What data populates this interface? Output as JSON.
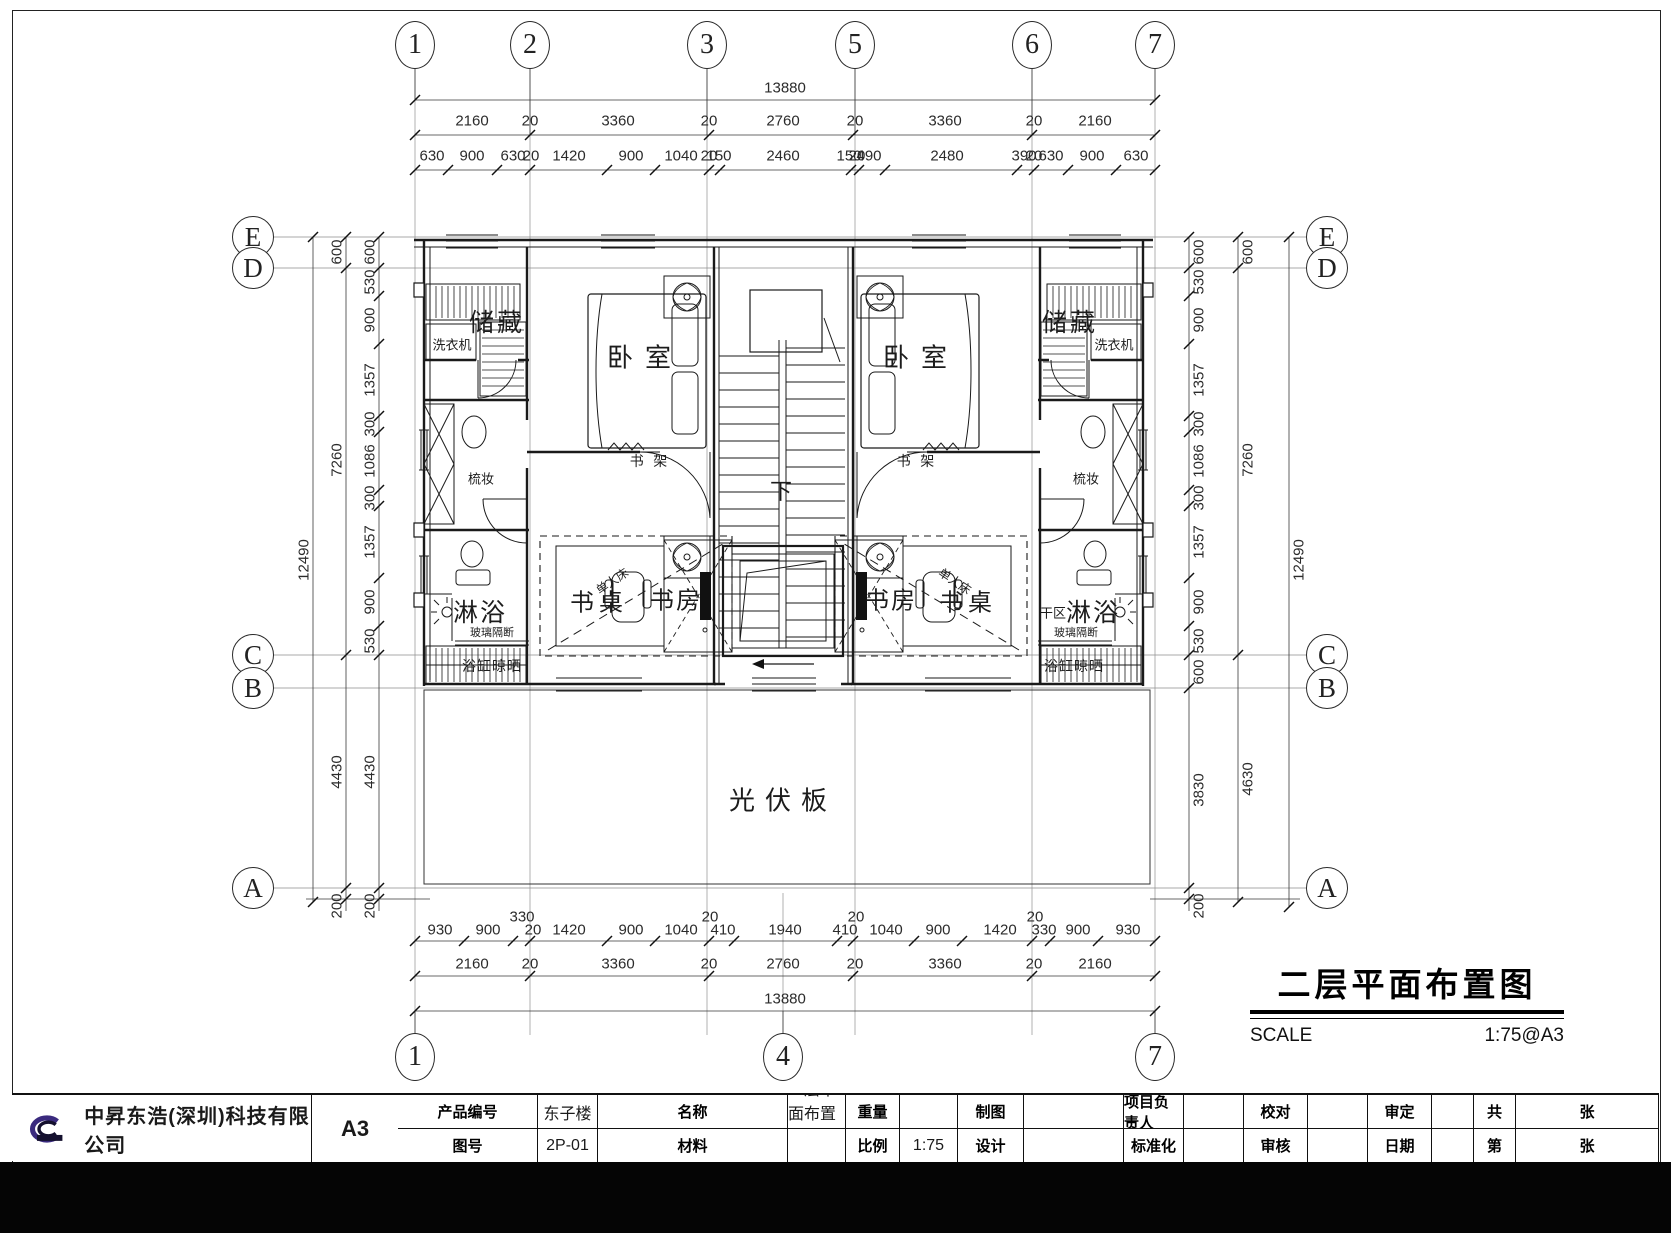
{
  "drawing_title": {
    "text": "二层平面布置图",
    "scale_label": "SCALE",
    "scale_value": "1:75@A3"
  },
  "grid": {
    "top": [
      {
        "label": "1",
        "x": 415
      },
      {
        "label": "2",
        "x": 530
      },
      {
        "label": "3",
        "x": 707
      },
      {
        "label": "5",
        "x": 855
      },
      {
        "label": "6",
        "x": 1032
      },
      {
        "label": "7",
        "x": 1155
      }
    ],
    "bottom": [
      {
        "label": "1",
        "x": 415
      },
      {
        "label": "4",
        "x": 783
      },
      {
        "label": "7",
        "x": 1155
      }
    ],
    "left": [
      {
        "label": "E",
        "y": 237
      },
      {
        "label": "D",
        "y": 268
      },
      {
        "label": "C",
        "y": 655
      },
      {
        "label": "B",
        "y": 688
      },
      {
        "label": "A",
        "y": 888
      }
    ],
    "right": [
      {
        "label": "E",
        "y": 237
      },
      {
        "label": "D",
        "y": 268
      },
      {
        "label": "C",
        "y": 655
      },
      {
        "label": "B",
        "y": 688
      },
      {
        "label": "A",
        "y": 888
      }
    ]
  },
  "labels": [
    {
      "t": "储藏",
      "x": 497,
      "y": 321,
      "s": 25,
      "ls": 3
    },
    {
      "t": "洗衣机",
      "x": 452,
      "y": 344,
      "s": 13
    },
    {
      "t": "梳妆",
      "x": 481,
      "y": 478,
      "s": 13
    },
    {
      "t": "淋浴",
      "x": 480,
      "y": 611,
      "s": 25,
      "ls": 2
    },
    {
      "t": "玻璃隔断",
      "x": 492,
      "y": 632,
      "s": 11
    },
    {
      "t": "浴缸晾晒",
      "x": 492,
      "y": 666,
      "s": 14,
      "ls": 1
    },
    {
      "t": "卧室",
      "x": 645,
      "y": 356,
      "s": 26,
      "ls": 12
    },
    {
      "t": "书 架",
      "x": 650,
      "y": 461,
      "s": 14,
      "ls": 3
    },
    {
      "t": "书桌",
      "x": 599,
      "y": 600,
      "s": 24,
      "ls": 5
    },
    {
      "t": "单人床",
      "x": 612,
      "y": 581,
      "s": 12,
      "r": -34
    },
    {
      "t": "书房",
      "x": 676,
      "y": 598,
      "s": 24,
      "ls": 2
    },
    {
      "t": "储藏",
      "x": 1070,
      "y": 321,
      "s": 25,
      "ls": 3
    },
    {
      "t": "洗衣机",
      "x": 1114,
      "y": 344,
      "s": 13
    },
    {
      "t": "梳妆",
      "x": 1086,
      "y": 478,
      "s": 13
    },
    {
      "t": "干区",
      "x": 1053,
      "y": 612,
      "s": 13
    },
    {
      "t": "淋浴",
      "x": 1093,
      "y": 611,
      "s": 25,
      "ls": 2
    },
    {
      "t": "玻璃隔断",
      "x": 1076,
      "y": 632,
      "s": 11
    },
    {
      "t": "浴缸晾晒",
      "x": 1074,
      "y": 666,
      "s": 14,
      "ls": 1
    },
    {
      "t": "卧室",
      "x": 921,
      "y": 356,
      "s": 26,
      "ls": 12
    },
    {
      "t": "书 架",
      "x": 917,
      "y": 461,
      "s": 14,
      "ls": 3
    },
    {
      "t": "书桌",
      "x": 968,
      "y": 600,
      "s": 24,
      "ls": 5
    },
    {
      "t": "单人床",
      "x": 955,
      "y": 581,
      "s": 12,
      "r": 34
    },
    {
      "t": "书房",
      "x": 891,
      "y": 598,
      "s": 24,
      "ls": 2
    },
    {
      "t": "下",
      "x": 781,
      "y": 490,
      "s": 22
    },
    {
      "t": "光伏板",
      "x": 783,
      "y": 799,
      "s": 26,
      "ls": 10
    }
  ],
  "dimensions": {
    "horizontal": [
      {
        "y": 88,
        "items": [
          {
            "v": "13880",
            "x": 785
          }
        ]
      },
      {
        "y": 121,
        "items": [
          {
            "v": "2160",
            "x": 472
          },
          {
            "v": "20",
            "x": 530
          },
          {
            "v": "3360",
            "x": 618
          },
          {
            "v": "20",
            "x": 709
          },
          {
            "v": "2760",
            "x": 783
          },
          {
            "v": "20",
            "x": 855
          },
          {
            "v": "3360",
            "x": 945
          },
          {
            "v": "20",
            "x": 1034
          },
          {
            "v": "2160",
            "x": 1095
          }
        ]
      },
      {
        "y": 156,
        "items": [
          {
            "v": "630",
            "x": 432
          },
          {
            "v": "900",
            "x": 472
          },
          {
            "v": "630",
            "x": 513
          },
          {
            "v": "20",
            "x": 531
          },
          {
            "v": "1420",
            "x": 569
          },
          {
            "v": "900",
            "x": 631
          },
          {
            "v": "1040",
            "x": 681
          },
          {
            "v": "20",
            "x": 709
          },
          {
            "v": "150",
            "x": 719
          },
          {
            "v": "2460",
            "x": 783
          },
          {
            "v": "150",
            "x": 849
          },
          {
            "v": "20",
            "x": 857
          },
          {
            "v": "490",
            "x": 869
          },
          {
            "v": "2480",
            "x": 947
          },
          {
            "v": "390",
            "x": 1024
          },
          {
            "v": "20",
            "x": 1034
          },
          {
            "v": "630",
            "x": 1051
          },
          {
            "v": "900",
            "x": 1092
          },
          {
            "v": "630",
            "x": 1136
          }
        ]
      },
      {
        "y": 917,
        "items": [
          {
            "v": "330",
            "x": 522
          },
          {
            "v": "20",
            "x": 710
          },
          {
            "v": "20",
            "x": 856
          },
          {
            "v": "20",
            "x": 1035
          }
        ]
      },
      {
        "y": 930,
        "items": [
          {
            "v": "930",
            "x": 440
          },
          {
            "v": "900",
            "x": 488
          },
          {
            "v": "20",
            "x": 533
          },
          {
            "v": "1420",
            "x": 569
          },
          {
            "v": "900",
            "x": 631
          },
          {
            "v": "1040",
            "x": 681
          },
          {
            "v": "410",
            "x": 723
          },
          {
            "v": "1940",
            "x": 785
          },
          {
            "v": "410",
            "x": 845
          },
          {
            "v": "1040",
            "x": 886
          },
          {
            "v": "900",
            "x": 938
          },
          {
            "v": "1420",
            "x": 1000
          },
          {
            "v": "330",
            "x": 1044
          },
          {
            "v": "900",
            "x": 1078
          },
          {
            "v": "930",
            "x": 1128
          }
        ]
      },
      {
        "y": 964,
        "items": [
          {
            "v": "2160",
            "x": 472
          },
          {
            "v": "20",
            "x": 530
          },
          {
            "v": "3360",
            "x": 618
          },
          {
            "v": "20",
            "x": 709
          },
          {
            "v": "2760",
            "x": 783
          },
          {
            "v": "20",
            "x": 855
          },
          {
            "v": "3360",
            "x": 945
          },
          {
            "v": "20",
            "x": 1034
          },
          {
            "v": "2160",
            "x": 1095
          }
        ]
      },
      {
        "y": 999,
        "items": [
          {
            "v": "13880",
            "x": 785
          }
        ]
      }
    ],
    "left_columns": [
      {
        "x": 370,
        "items": [
          {
            "v": "600",
            "y": 252
          },
          {
            "v": "530",
            "y": 282
          },
          {
            "v": "900",
            "y": 320
          },
          {
            "v": "1357",
            "y": 380
          },
          {
            "v": "300",
            "y": 424
          },
          {
            "v": "1086",
            "y": 461
          },
          {
            "v": "300",
            "y": 498
          },
          {
            "v": "1357",
            "y": 542
          },
          {
            "v": "900",
            "y": 602
          },
          {
            "v": "530",
            "y": 641
          },
          {
            "v": "4430",
            "y": 772
          },
          {
            "v": "200",
            "y": 906
          }
        ]
      },
      {
        "x": 337,
        "items": [
          {
            "v": "600",
            "y": 252
          },
          {
            "v": "7260",
            "y": 460
          },
          {
            "v": "4430",
            "y": 772
          },
          {
            "v": "200",
            "y": 906
          }
        ]
      },
      {
        "x": 304,
        "items": [
          {
            "v": "12490",
            "y": 560
          }
        ]
      }
    ],
    "right_columns": [
      {
        "x": 1199,
        "items": [
          {
            "v": "600",
            "y": 252
          },
          {
            "v": "530",
            "y": 282
          },
          {
            "v": "900",
            "y": 320
          },
          {
            "v": "1357",
            "y": 380
          },
          {
            "v": "300",
            "y": 424
          },
          {
            "v": "1086",
            "y": 461
          },
          {
            "v": "300",
            "y": 498
          },
          {
            "v": "1357",
            "y": 542
          },
          {
            "v": "900",
            "y": 602
          },
          {
            "v": "530",
            "y": 641
          },
          {
            "v": "600",
            "y": 672
          },
          {
            "v": "3830",
            "y": 790
          },
          {
            "v": "200",
            "y": 906
          }
        ]
      },
      {
        "x": 1248,
        "items": [
          {
            "v": "600",
            "y": 252
          },
          {
            "v": "7260",
            "y": 460
          },
          {
            "v": "4630",
            "y": 779
          }
        ]
      },
      {
        "x": 1299,
        "items": [
          {
            "v": "12490",
            "y": 560
          }
        ]
      }
    ]
  },
  "title_block": {
    "company": "中昇东浩(深圳)科技有限公司",
    "r1": [
      "产品编号",
      "东子楼",
      "名称",
      "二层平面布置图",
      "重量",
      "",
      "制图",
      "",
      "项目负责人",
      "",
      "校对",
      "",
      "审定",
      "",
      "共",
      "张"
    ],
    "r2": [
      "图号",
      "2P-01",
      "材料",
      "",
      "比例",
      "1:75",
      "设计",
      "",
      "标准化",
      "",
      "审核",
      "",
      "日期",
      "",
      "第",
      "张"
    ],
    "sheet_size": "A3"
  }
}
